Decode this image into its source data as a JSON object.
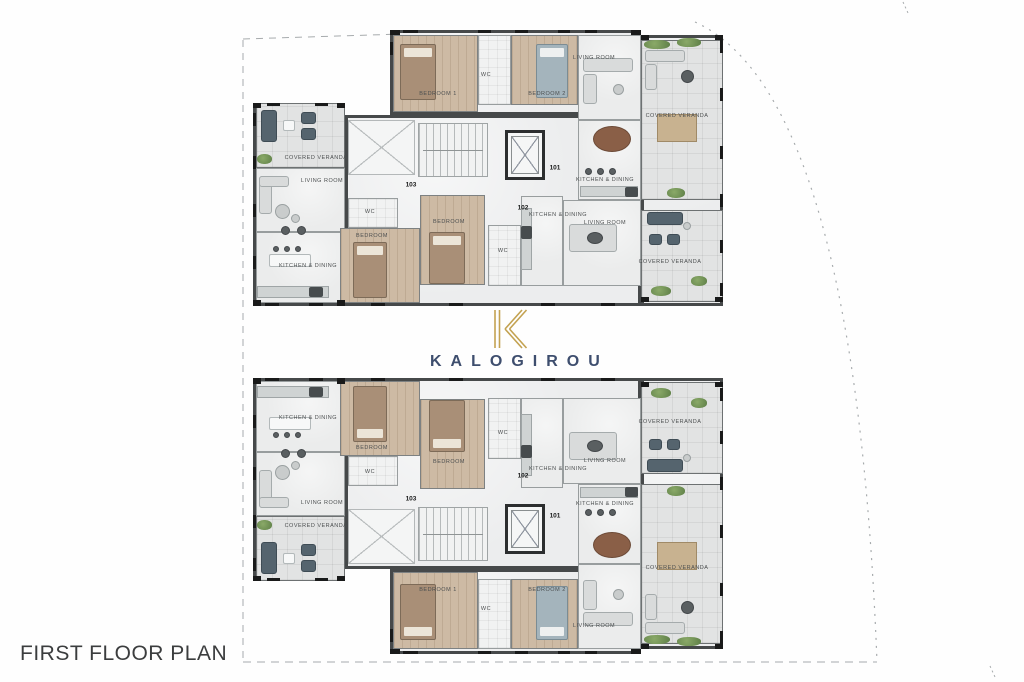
{
  "title": "FIRST FLOOR PLAN",
  "logo": {
    "monogram": "K",
    "wordmark": "KALOGIROU"
  },
  "colors": {
    "wall": "#46494a",
    "floor": "#ecedee",
    "wood": "#cdbaa4",
    "veranda": "#e2e3e3",
    "tilewc": "#f1f2f2",
    "gold": "#c3a251",
    "navy": "#3e4e6e",
    "label": "#4c4f50",
    "ink": "#1a1b1b",
    "boundary": "#a7abad",
    "navyfurn": "#55646e",
    "title": "#3b3d3e"
  },
  "plans": [
    {
      "name": "floor-plan-upper",
      "mirrored": false
    },
    {
      "name": "floor-plan-lower",
      "mirrored": true
    }
  ],
  "unit_layout": {
    "width": 470,
    "height": 278,
    "parts": [
      [
        0,
        75,
        92,
        203
      ],
      [
        92,
        87,
        296,
        191
      ],
      [
        137,
        2,
        251,
        85
      ],
      [
        388,
        7,
        82,
        271
      ]
    ],
    "rooms": [
      {
        "n": "bedroom-1",
        "floor": "wood",
        "r": [
          140,
          7,
          85,
          77
        ]
      },
      {
        "n": "wc-a",
        "floor": "tile",
        "r": [
          225,
          7,
          33,
          70
        ]
      },
      {
        "n": "bedroom-2",
        "floor": "wood",
        "r": [
          258,
          7,
          67,
          70
        ]
      },
      {
        "n": "living-room-a",
        "floor": "main",
        "r": [
          325,
          7,
          63,
          85
        ]
      },
      {
        "n": "covered-veranda-a",
        "floor": "veranda",
        "r": [
          388,
          12,
          82,
          160
        ]
      },
      {
        "n": "kitchen-dining-a",
        "floor": "main",
        "r": [
          325,
          92,
          63,
          80
        ]
      },
      {
        "n": "covered-veranda-b",
        "floor": "veranda",
        "r": [
          3,
          75,
          89,
          65
        ]
      },
      {
        "n": "living-room-b",
        "floor": "main",
        "r": [
          3,
          140,
          89,
          64
        ]
      },
      {
        "n": "kitchen-dining-b",
        "floor": "main",
        "r": [
          3,
          204,
          89,
          71
        ]
      },
      {
        "n": "wc-b",
        "floor": "tile",
        "r": [
          95,
          170,
          50,
          30
        ]
      },
      {
        "n": "bedroom-b",
        "floor": "wood",
        "r": [
          87,
          200,
          80,
          75
        ]
      },
      {
        "n": "bedroom-c",
        "floor": "wood",
        "r": [
          167,
          167,
          65,
          90
        ]
      },
      {
        "n": "wc-c",
        "floor": "tile",
        "r": [
          235,
          197,
          33,
          61
        ]
      },
      {
        "n": "kitchen-dining-c",
        "floor": "main",
        "r": [
          268,
          168,
          42,
          90
        ]
      },
      {
        "n": "living-room-c",
        "floor": "main",
        "r": [
          310,
          172,
          78,
          86
        ]
      },
      {
        "n": "covered-veranda-c",
        "floor": "veranda",
        "r": [
          388,
          182,
          82,
          92
        ]
      }
    ],
    "labels": [
      [
        "BEDROOM 1",
        185,
        66
      ],
      [
        "WC",
        233,
        47
      ],
      [
        "BEDROOM 2",
        294,
        66
      ],
      [
        "LIVING ROOM",
        341,
        30
      ],
      [
        "COVERED VERANDA",
        424,
        88
      ],
      [
        "KITCHEN & DINING",
        352,
        152
      ],
      [
        "COVERED VERANDA",
        63,
        130
      ],
      [
        "LIVING ROOM",
        69,
        153
      ],
      [
        "KITCHEN & DINING",
        55,
        238
      ],
      [
        "WC",
        117,
        184
      ],
      [
        "BEDROOM",
        119,
        208
      ],
      [
        "BEDROOM",
        196,
        194
      ],
      [
        "WC",
        250,
        223
      ],
      [
        "KITCHEN & DINING",
        305,
        187
      ],
      [
        "LIVING ROOM",
        352,
        195
      ],
      [
        "COVERED VERANDA",
        417,
        234
      ]
    ],
    "numbers": [
      [
        "101",
        302,
        140
      ],
      [
        "102",
        270,
        180
      ],
      [
        "103",
        158,
        157
      ]
    ],
    "furniture": [
      [
        "bed",
        147,
        16,
        36,
        56
      ],
      [
        "bedblue",
        283,
        16,
        32,
        54
      ],
      [
        "bed",
        100,
        214,
        34,
        56
      ],
      [
        "bed",
        176,
        204,
        36,
        52
      ],
      [
        "sofa",
        330,
        30,
        50,
        14
      ],
      [
        "sofa",
        330,
        46,
        14,
        30
      ],
      [
        "dotlight",
        360,
        56,
        11,
        11
      ],
      [
        "oval",
        340,
        98,
        38,
        26
      ],
      [
        "dot",
        332,
        140,
        7,
        7
      ],
      [
        "dot",
        344,
        140,
        7,
        7
      ],
      [
        "dot",
        356,
        140,
        7,
        7
      ],
      [
        "counter",
        327,
        158,
        58,
        11
      ],
      [
        "dark",
        372,
        159,
        13,
        10
      ],
      [
        "sofa",
        392,
        22,
        40,
        12
      ],
      [
        "sofa",
        392,
        36,
        12,
        26
      ],
      [
        "dot",
        428,
        42,
        13,
        13
      ],
      [
        "dining",
        404,
        86,
        40,
        28
      ],
      [
        "plant",
        391,
        12,
        26,
        9
      ],
      [
        "plant",
        424,
        10,
        24,
        9
      ],
      [
        "plant",
        414,
        160,
        18,
        10
      ],
      [
        "navy",
        8,
        82,
        16,
        32
      ],
      [
        "white",
        30,
        92,
        12,
        11
      ],
      [
        "navy",
        48,
        84,
        15,
        12
      ],
      [
        "navy",
        48,
        100,
        15,
        12
      ],
      [
        "plant",
        4,
        126,
        15,
        10
      ],
      [
        "sofa",
        6,
        148,
        13,
        38
      ],
      [
        "sofa",
        6,
        148,
        30,
        11
      ],
      [
        "dotlight",
        22,
        176,
        15,
        15
      ],
      [
        "dotlight",
        38,
        186,
        9,
        9
      ],
      [
        "dot",
        28,
        198,
        9,
        9
      ],
      [
        "dot",
        44,
        198,
        9,
        9
      ],
      [
        "white",
        16,
        226,
        42,
        13
      ],
      [
        "dot",
        20,
        218,
        6,
        6
      ],
      [
        "dot",
        31,
        218,
        6,
        6
      ],
      [
        "dot",
        42,
        218,
        6,
        6
      ],
      [
        "counter",
        4,
        258,
        72,
        12
      ],
      [
        "dark",
        56,
        259,
        14,
        10
      ],
      [
        "counter",
        268,
        180,
        11,
        62
      ],
      [
        "dark",
        268,
        198,
        11,
        13
      ],
      [
        "sofa",
        316,
        196,
        48,
        28
      ],
      [
        "dot",
        334,
        204,
        16,
        12
      ],
      [
        "navy",
        394,
        184,
        36,
        13
      ],
      [
        "navy",
        396,
        206,
        13,
        11
      ],
      [
        "navy",
        414,
        206,
        13,
        11
      ],
      [
        "dotlight",
        430,
        194,
        8,
        8
      ],
      [
        "plant",
        398,
        258,
        20,
        10
      ],
      [
        "plant",
        438,
        248,
        16,
        10
      ],
      [
        "stairs",
        165,
        95,
        70,
        54
      ],
      [
        "elev",
        252,
        102,
        40,
        50
      ],
      [
        "voidx",
        95,
        92,
        67,
        55
      ]
    ],
    "marks": [
      [
        0,
        85,
        3,
        13
      ],
      [
        0,
        128,
        3,
        13
      ],
      [
        0,
        176,
        3,
        13
      ],
      [
        0,
        228,
        3,
        13
      ],
      [
        14,
        75,
        13,
        3
      ],
      [
        62,
        75,
        13,
        3
      ],
      [
        12,
        275,
        14,
        3
      ],
      [
        56,
        275,
        14,
        3
      ],
      [
        137,
        14,
        3,
        13
      ],
      [
        150,
        2,
        15,
        3
      ],
      [
        225,
        2,
        13,
        3
      ],
      [
        262,
        2,
        13,
        3
      ],
      [
        305,
        2,
        12,
        3
      ],
      [
        332,
        2,
        12,
        3
      ],
      [
        467,
        12,
        3,
        13
      ],
      [
        467,
        60,
        3,
        13
      ],
      [
        467,
        118,
        3,
        13
      ],
      [
        467,
        166,
        3,
        13
      ],
      [
        467,
        212,
        3,
        13
      ],
      [
        467,
        255,
        3,
        13
      ],
      [
        118,
        275,
        14,
        3
      ],
      [
        196,
        275,
        14,
        3
      ],
      [
        288,
        275,
        14,
        3
      ],
      [
        348,
        275,
        14,
        3
      ],
      [
        137,
        2,
        10,
        5
      ],
      [
        378,
        2,
        10,
        5
      ],
      [
        388,
        7,
        8,
        5
      ],
      [
        462,
        7,
        8,
        5
      ],
      [
        388,
        269,
        8,
        5
      ],
      [
        462,
        269,
        8,
        5
      ],
      [
        0,
        75,
        8,
        5
      ],
      [
        84,
        75,
        8,
        5
      ],
      [
        0,
        272,
        8,
        6
      ],
      [
        84,
        272,
        8,
        6
      ]
    ]
  }
}
